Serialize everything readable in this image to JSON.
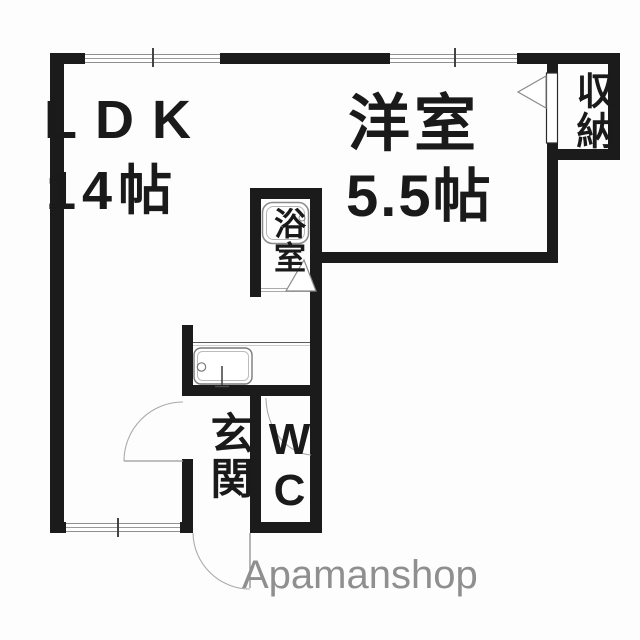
{
  "floorplan": {
    "rooms": [
      {
        "id": "ldk",
        "name": "LDK",
        "size": "14帖"
      },
      {
        "id": "yoshitsu",
        "name": "洋室",
        "size": "5.5帖"
      },
      {
        "id": "bath",
        "name": "浴室"
      },
      {
        "id": "closet",
        "name": "収納"
      },
      {
        "id": "genkan",
        "name": "玄関"
      },
      {
        "id": "wc",
        "name": "WC"
      }
    ],
    "watermark": "Apamanshop",
    "colors": {
      "wall": "#1b1b1b",
      "fixture_line": "#8a8a8a",
      "watermark": "#8f8f8f",
      "background": "#fdfdfd"
    }
  }
}
